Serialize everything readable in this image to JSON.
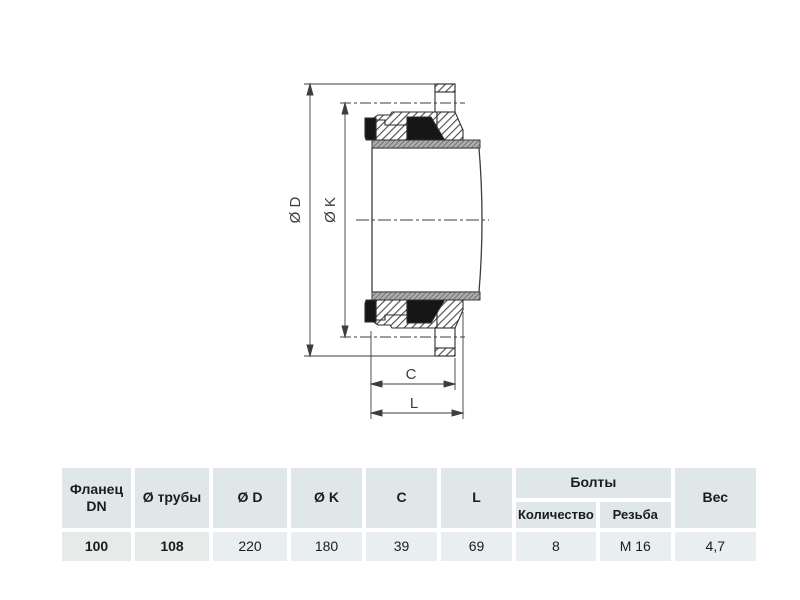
{
  "drawing": {
    "dim_d_label": "Ø D",
    "dim_k_label": "Ø K",
    "dim_c_label": "C",
    "dim_l_label": "L",
    "colors": {
      "line": "#3d3d3d",
      "seal": "#161616",
      "gray_band": "#a9a9a9"
    }
  },
  "table": {
    "headers": {
      "flange_dn": "Фланец\nDN",
      "pipe_dia": "Ø трубы",
      "dia_d": "Ø D",
      "dia_k": "Ø K",
      "c": "C",
      "l": "L",
      "bolts": "Болты",
      "bolts_qty": "Количество",
      "bolts_thread": "Резьба",
      "weight": "Вес"
    },
    "row": {
      "flange_dn": "100",
      "pipe_dia": "108",
      "dia_d": "220",
      "dia_k": "180",
      "c": "39",
      "l": "69",
      "bolts_qty": "8",
      "bolts_thread": "М 16",
      "weight": "4,7"
    },
    "colors": {
      "header_bg": "#dfe7e8",
      "row_bg": "#e9eff1",
      "row_key_bg": "#e6eae8",
      "text": "#1c1c1c"
    }
  }
}
